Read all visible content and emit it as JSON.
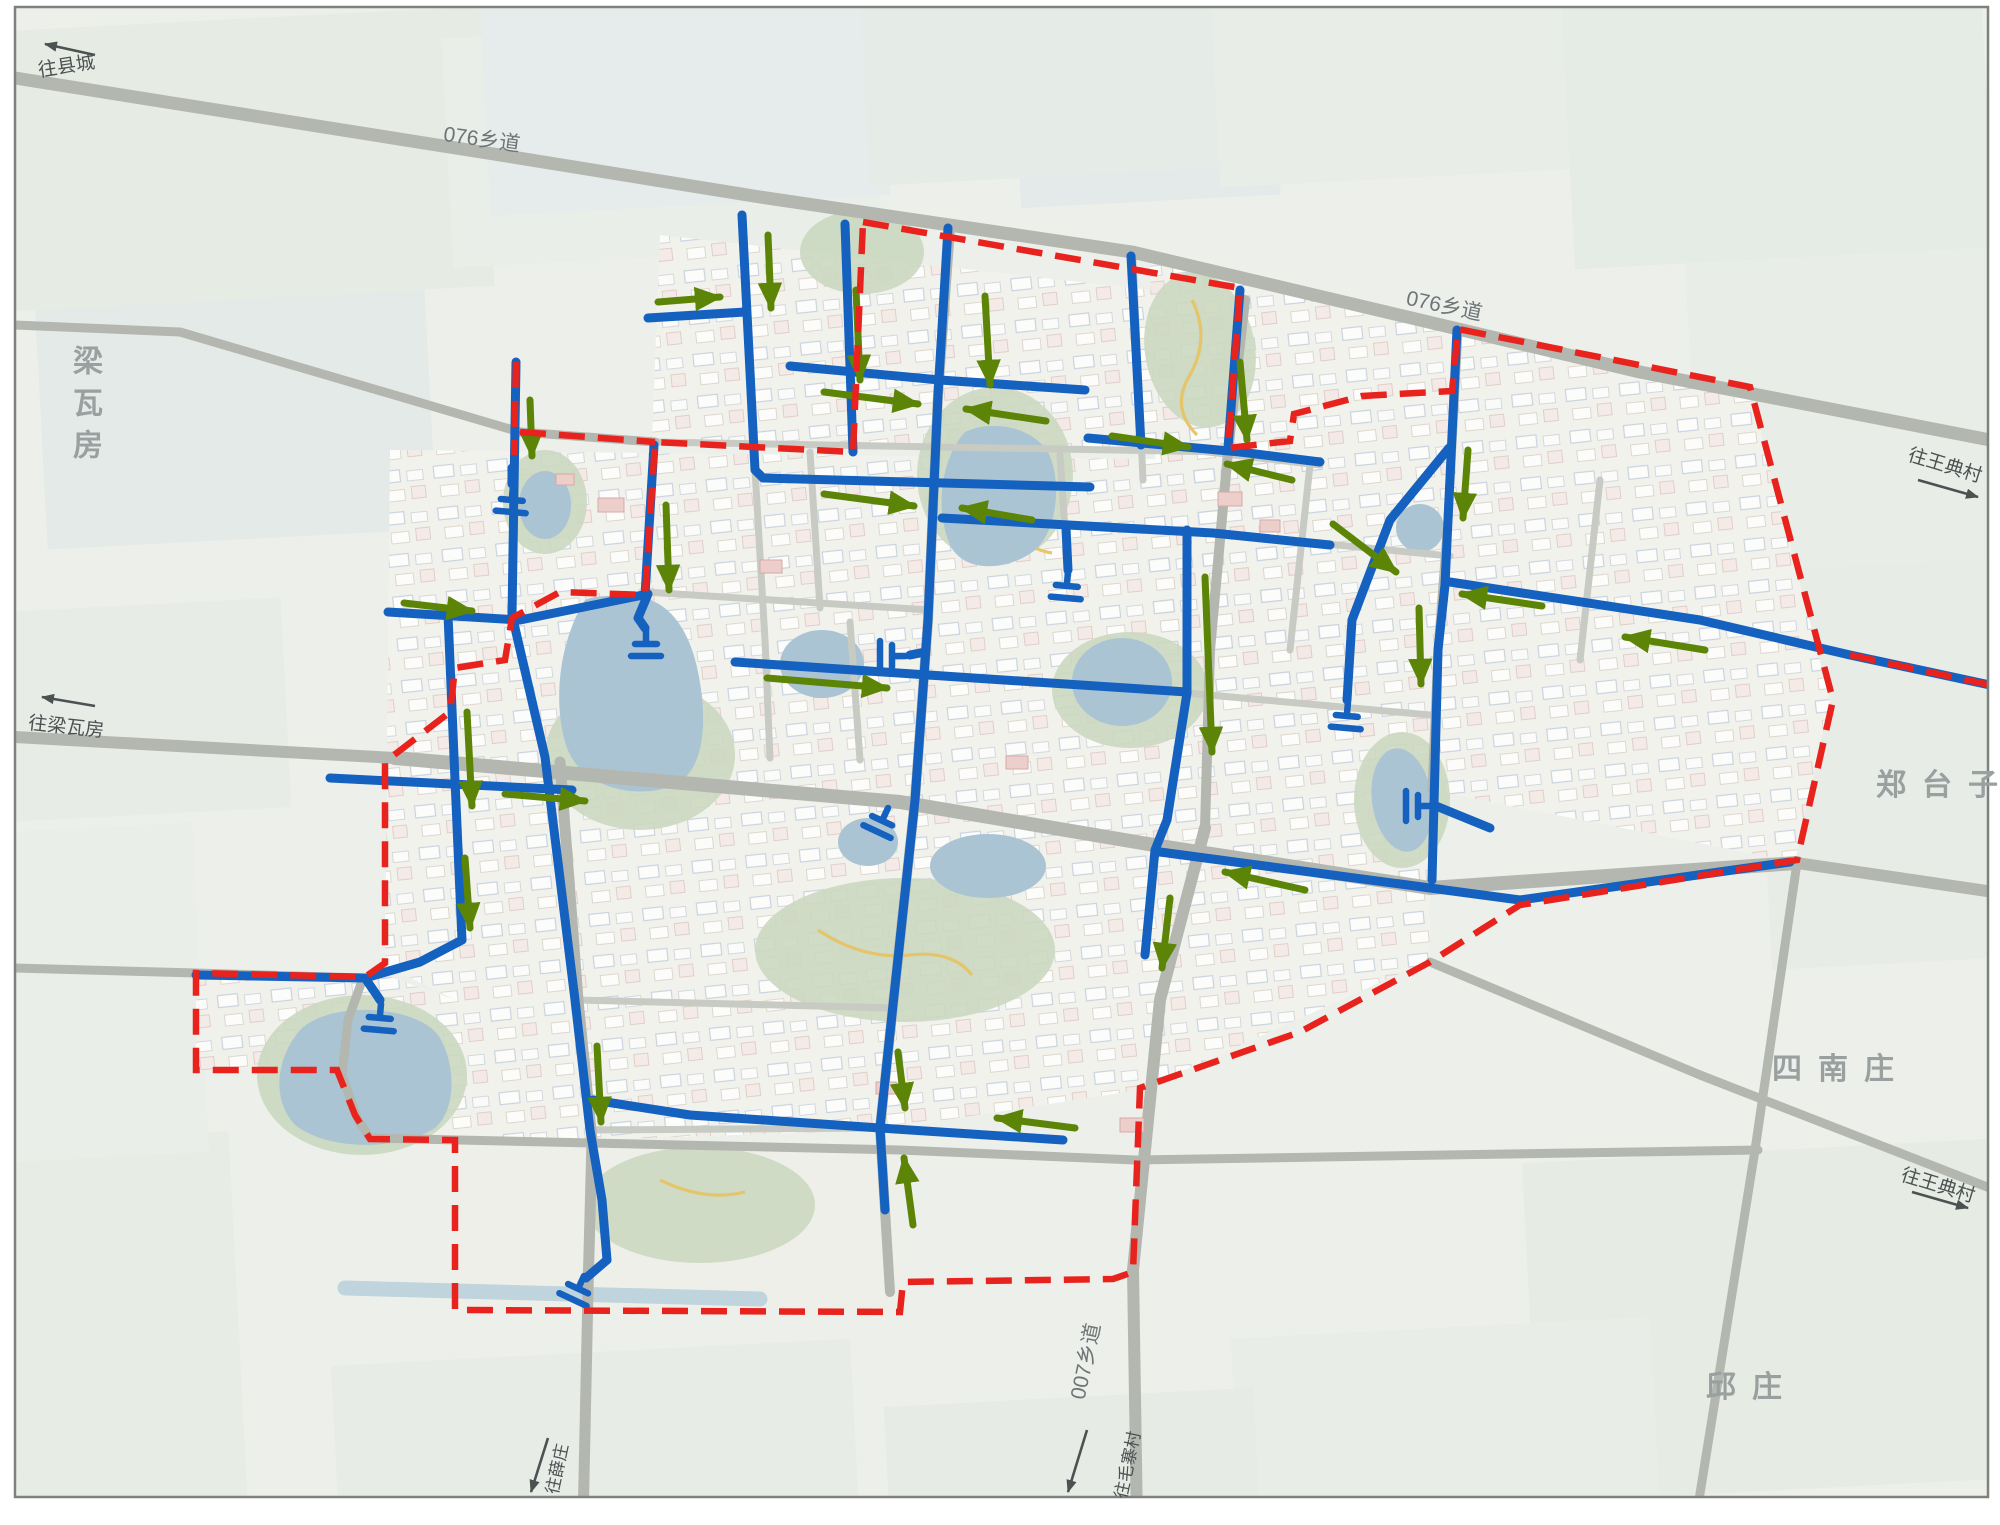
{
  "map": {
    "kind": "township drainage / flow-direction planning map",
    "place_names": {
      "liangwafang": "梁瓦房",
      "zhengtaizi": "郑台子",
      "sinanzhuang": "四南庄",
      "qiuzhuang": "邱庄"
    },
    "road_names": {
      "township_076_west": "076乡道",
      "township_076_east": "076乡道",
      "township_007": "007乡道"
    },
    "directions": {
      "to_county_town": "往县城",
      "to_liangwafang": "往梁瓦房",
      "to_wangdian_north": "往王典村",
      "to_wangdian_south": "往王典村",
      "to_maozhai": "往毛寨村",
      "to_xuezhuang": "往薛庄"
    },
    "colors": {
      "pipe_flow_blue": "#1561bf",
      "flow_arrow_green": "#5c8406",
      "planning_boundary_red": "#e8231d",
      "main_road_gray": "#b3b7b0",
      "water_blue": "#aac4d3",
      "park_green": "#cbd8c0"
    }
  }
}
